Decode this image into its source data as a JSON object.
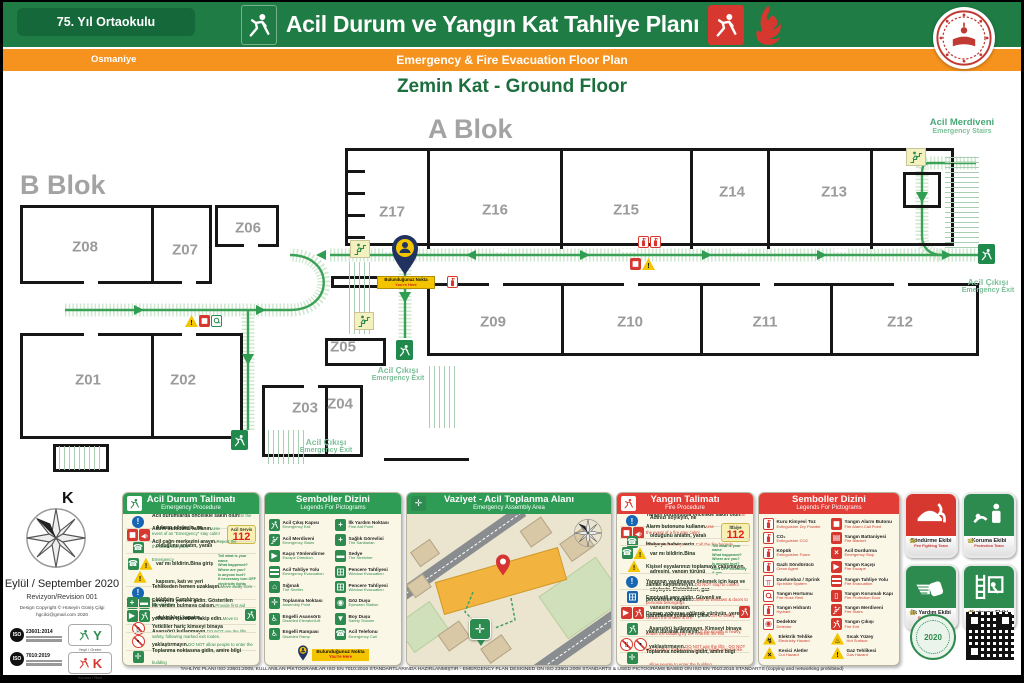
{
  "header": {
    "school_name": "75. Yıl Ortaokulu",
    "city": "Osmaniye",
    "title_tr": "Acil Durum ve Yangın Kat Tahliye Planı",
    "title_en": "Emergency & Fire Evacuation Floor Plan",
    "floor_label": "Zemin Kat - Ground Floor"
  },
  "floor_plan": {
    "blocks": [
      "A Blok",
      "B Blok"
    ],
    "rooms": [
      {
        "id": "Z01",
        "x": 84,
        "y": 280
      },
      {
        "id": "Z02",
        "x": 179,
        "y": 280
      },
      {
        "id": "Z03",
        "x": 301,
        "y": 308
      },
      {
        "id": "Z04",
        "x": 336,
        "y": 304
      },
      {
        "id": "Z05",
        "x": 339,
        "y": 247
      },
      {
        "id": "Z06",
        "x": 244,
        "y": 128
      },
      {
        "id": "Z07",
        "x": 181,
        "y": 150
      },
      {
        "id": "Z08",
        "x": 81,
        "y": 147
      },
      {
        "id": "Z09",
        "x": 489,
        "y": 222
      },
      {
        "id": "Z10",
        "x": 626,
        "y": 222
      },
      {
        "id": "Z11",
        "x": 761,
        "y": 222
      },
      {
        "id": "Z12",
        "x": 896,
        "y": 222
      },
      {
        "id": "Z13",
        "x": 830,
        "y": 92
      },
      {
        "id": "Z14",
        "x": 728,
        "y": 92
      },
      {
        "id": "Z15",
        "x": 622,
        "y": 110
      },
      {
        "id": "Z16",
        "x": 491,
        "y": 110
      },
      {
        "id": "Z17",
        "x": 388,
        "y": 112
      }
    ],
    "labels": {
      "emergency_exit_tr": "Acil Çıkışı",
      "emergency_exit_en": "Emergency Exit",
      "emergency_stairs_tr": "Acil Merdiveni",
      "emergency_stairs_en": "Emergency Stairs",
      "you_are_here_tr": "Bulunduğunuz Nokta",
      "you_are_here_en": "You're Here"
    }
  },
  "panels": {
    "emergency": {
      "title": "Acil Durum Talimatı",
      "subtitle": "Emergency Procedure",
      "rows": [
        {
          "icons": [
            "info-circle"
          ],
          "tr": "Acil durumlarda öncelikle sakin olun!",
          "en": "In the event of an \"Emergency\" stay calm!"
        },
        {
          "icons": [
            "alarm-button",
            "megaphone"
          ],
          "tr": "Alarm butonunu kullanın.",
          "en": "Use the alarm call point",
          "badge": {
            "title": "Acil Servis",
            "number": "112"
          }
        },
        {
          "icons": [
            "emergency-phone"
          ],
          "tr": "Acil çağrı merkezini arayın.",
          "en": "Report the Emergency"
        },
        {
          "icons": [
            "emergency-phone",
            "warning",
            "warning"
          ],
          "tr": "Adınızı söyleyin, ne olduğunu anlatın, yaralı var mı bildirin.",
          "tr2": "Bina giriş kapısını, katı ve yeri bildirin. Gerekirse elektrikleri kapatın.",
          "side": [
            "Tell what is your name",
            "What happened?",
            "Where are you?",
            "Is anyone hurt?",
            "If necessary turn OFF electricity lights"
          ]
        },
        {
          "icons": [
            "info-circle"
          ],
          "tr": "Tehlikeden hemen uzaklaşın.",
          "en": "Move away from any danger"
        },
        {
          "icons": [
            "first-aid",
            "stretcher"
          ],
          "tr": "İlk yardım bulmaya çalışın.",
          "en": "Provide first aid"
        },
        {
          "icons": [
            "arrow-green",
            "evacuation"
          ],
          "tr": "Emniyetli yerlere gidin. Gösterilen yollardan işaretleri takip edin.",
          "en": "Move to safety, following marked exit routes.",
          "trail": "exit-mini"
        },
        {
          "icons": [
            "no-elevator"
          ],
          "tr": "Asansörü kullanmayın.",
          "en": "DO NOT use the lifts"
        },
        {
          "icons": [
            "no-entry"
          ],
          "tr": "Yetkililer hariç kimseyi binaya yaklaştırmayın.",
          "en": "DO NOT allow people to enter the building"
        },
        {
          "icons": [
            "assembly-point"
          ],
          "tr": "Toplanma noktasına gidin, amire bilgi verin.",
          "en": "Proceed directly to your assembly point"
        }
      ]
    },
    "legend_green": {
      "title": "Semboller Dizini",
      "subtitle": "Legends For Pictograms",
      "items": [
        {
          "icon": "exit-door",
          "tr": "Acil Çıkış Kapısı",
          "en": "Emergency Exit"
        },
        {
          "icon": "emergency-stairs",
          "tr": "Acil Merdiveni",
          "en": "Emergency Stairs"
        },
        {
          "icon": "escape-direction",
          "tr": "Kaçış Yönlendirme",
          "en": "Escape Direction"
        },
        {
          "icon": "evacuation-route",
          "tr": "Acil Tahliye Yolu",
          "en": "Emergency Evacuation"
        },
        {
          "icon": "shelter",
          "tr": "Sığınak",
          "en": "The Shelter"
        },
        {
          "icon": "assembly-point",
          "tr": "Toplanma Noktası",
          "en": "Assembly Point"
        },
        {
          "icon": "disabled-lift",
          "tr": "Engelli Asansörü",
          "en": "Disabled Elevator/Lift"
        },
        {
          "icon": "disabled-ramp",
          "tr": "Engelli Rampası",
          "en": "Disabled Ramp"
        },
        {
          "icon": "first-aid",
          "tr": "İlk Yardım Noktası",
          "en": "First Aid Point"
        },
        {
          "icon": "sanitarian",
          "tr": "Sağlık Görevlisi",
          "en": "The Sanitarian"
        },
        {
          "icon": "stretcher",
          "tr": "Sedye",
          "en": "The Stretcher"
        },
        {
          "icon": "window-evac",
          "tr": "Pencere Tahliyesi",
          "en": "Window Evacuation"
        },
        {
          "icon": "window-evac",
          "tr": "Pencere Tahliyesi",
          "en": "Window Evacuation"
        },
        {
          "icon": "eyewash",
          "tr": "Göz Duşu",
          "en": "Eyewash Station"
        },
        {
          "icon": "safety-shower",
          "tr": "Boy Duşu",
          "en": "Safety Shower"
        },
        {
          "icon": "emergency-phone-green",
          "tr": "Acil Telefonu",
          "en": "Emergency Call"
        }
      ]
    },
    "assembly_map": {
      "title": "Vaziyet - Acil Toplanma Alanı",
      "subtitle": "Emergency Assembly Area"
    },
    "fire": {
      "title": "Yangın Talimatı",
      "subtitle": "Fire Procedure",
      "rows": [
        {
          "icons": [
            "info-circle"
          ],
          "tr": "Yangın durumunda öncelikle sakin olun!",
          "en": "In the event of a fire stay calm!"
        },
        {
          "icons": [
            "alarm-button",
            "megaphone"
          ],
          "tr": "Alarm butonunu kullanın.",
          "en": "Use the fire alarm call point",
          "badge": {
            "title": "İtfaiye",
            "number": "112"
          }
        },
        {
          "icons": [
            "emergency-phone"
          ],
          "tr": "İtfaiyeye haber verin.",
          "en": "Call the fire brigade"
        },
        {
          "icons": [
            "emergency-phone",
            "warning",
            "warning"
          ],
          "tr": "Adınızı söyleyin, ne olduğunu anlatın, yaralı var mı bildirin.",
          "tr2": "Bina adresini, yangın türünü söyleyin. Elektrikleri, gaz vanasını kapatın.",
          "side": [
            "Tell what is your name",
            "What happened?",
            "Where are you?",
            "Is anyone hurt?",
            "Turn OFF electricity & gas"
          ]
        },
        {
          "icons": [
            "info-circle"
          ],
          "tr": "Kişisel eşyalarınızı toplamaya çalışmayın, zaman kaybetmeyin.",
          "en": "DO NOT stop to collect personal belongings"
        },
        {
          "icons": [
            "window-close"
          ],
          "tr": "Yangının yayılmasını önlemek için kapı ve pencereleri kapatın.",
          "en": "Close all windows & doors to contain the smoke & fire."
        },
        {
          "icons": [
            "arrow-red",
            "fire-exit-mini"
          ],
          "tr": "Emniyetli yere gidin. Güvenli ve işaretlenen yollardan çıkın.",
          "en": "Get to safety. Leave the building by the nearest fire exit",
          "trail": "fire-exit-mini"
        },
        {
          "icons": [
            "crawl"
          ],
          "tr": "Duman yoğunsa eğilerek yürüyün, yere yakın durarak ilerleyin.",
          "en": "If the smoke is heavy, stay close to the ground, you'll breathe less smoke."
        },
        {
          "icons": [
            "no-elevator",
            "no-entry"
          ],
          "tr": "Asansörü kullanmayın. Kimseyi binaya yaklaştırmayın.",
          "en": "DO NOT use the lifts · DO NOT allow people to enter the building"
        },
        {
          "icons": [
            "assembly-point"
          ],
          "tr": "Toplanma noktasına gidin, amire bilgi verin.",
          "en": "Proceed directly to your assembly point"
        }
      ]
    },
    "legend_red": {
      "title": "Semboller Dizini",
      "subtitle": "Legends For Pictograms",
      "items": [
        {
          "icon": "ext-powder",
          "tr": "Kuru Kimyevi Toz",
          "en": "Extinguisher Dry Powder"
        },
        {
          "icon": "ext-co2",
          "tr": "CO₂",
          "en": "Extinguisher CO2"
        },
        {
          "icon": "ext-foam",
          "tr": "Köpük",
          "en": "Extinguisher Foam"
        },
        {
          "icon": "ext-clean",
          "tr": "Gazlı Söndürücü",
          "en": "Clean Agent"
        },
        {
          "icon": "sprinkler",
          "tr": "Davlumbaz / Sprink",
          "en": "Sprinkler System"
        },
        {
          "icon": "fire-hose",
          "tr": "Yangın Hortumu",
          "en": "Fire Hose Reel"
        },
        {
          "icon": "hydrant",
          "tr": "Yangın Hidrantı",
          "en": "Hydrant"
        },
        {
          "icon": "detector",
          "tr": "Dedektör",
          "en": "Detector"
        },
        {
          "icon": "electric-hazard",
          "tr": "Elektrik Tehlike",
          "en": "Electricity Hazard"
        },
        {
          "icon": "cut-hazard",
          "tr": "Kesici Aletler",
          "en": "Cut Hazard"
        },
        {
          "icon": "fire-alarm",
          "tr": "Yangın Alarm Butonu",
          "en": "Fire Alarm Call Point"
        },
        {
          "icon": "fire-blanket",
          "tr": "Yangın Battaniyesi",
          "en": "Fire Blanket"
        },
        {
          "icon": "emergency-stop",
          "tr": "Acil Durdurma",
          "en": "Emergency Stop"
        },
        {
          "icon": "fire-escape",
          "tr": "Yangın Kaçışı",
          "en": "Fire Escape"
        },
        {
          "icon": "fire-route",
          "tr": "Yangın Tahliye Yolu",
          "en": "Fire Evacuation"
        },
        {
          "icon": "fire-door",
          "tr": "Yangın Korumalı Kapı",
          "en": "Fire Protection Door"
        },
        {
          "icon": "fire-stairs",
          "tr": "Yangın Merdiveni",
          "en": "Fire Stairs"
        },
        {
          "icon": "fire-exit",
          "tr": "Yangın Çıkışı",
          "en": "Fire Exit"
        },
        {
          "icon": "hot-surface",
          "tr": "Sıcak Yüzey",
          "en": "Hot Surface"
        },
        {
          "icon": "gas-hazard",
          "tr": "Gaz Tehlikesi",
          "en": "Gas Hazard"
        }
      ]
    }
  },
  "teams": [
    {
      "tr": "Söndürme Ekibi",
      "en": "Fire Fighting Team",
      "color": "#d6382f",
      "icon": "helmet-flame"
    },
    {
      "tr": "Koruma Ekibi",
      "en": "Protection Team",
      "color": "#2e8b4f",
      "icon": "protection"
    },
    {
      "tr": "İlk Yardım Ekibi",
      "en": "First Aid Team",
      "color": "#2e8b4f",
      "icon": "first-aid-hand"
    },
    {
      "tr": "Kurtarma Ekibi",
      "en": "Rescue Team",
      "color": "#2e8b4f",
      "icon": "ladder-rescue"
    }
  ],
  "info": {
    "north": "K",
    "date": "Eylül / September 2020",
    "revision": "Revizyon/Revision  001",
    "copyright_line1": "Design Copyright © Hüseyin Güniş Çilgi",
    "copyright_line2": "hgcilci@gmail.com 2020",
    "iso_1": "23601:2014",
    "iso_2": "7010:2019",
    "green_key_letter": "Y",
    "green_key_label": "Yeşil / Green",
    "red_key_letter": "K",
    "red_key_label": "Kırmızı / Red",
    "seal_year": "2020"
  },
  "footer": "TAHLİYE PLANI ISO 23601:2009, KULLANILAN PİKTOGRAMLAR ISO EN 7010:2016 STANDARTLARINDA HAZIRLANMIŞTIR - EMERGENCY PLAN DESIGNED ON ISO 23601:2009 STANDARTS & USED PICTOGRAMS BASED ON ISO EN 7010:2016 STANDARTS (copying and networking prohibited)",
  "colors": {
    "green": "#1e7c44",
    "orange": "#f6921e",
    "red": "#d6382f",
    "route_green": "#2f9e52",
    "cream": "#faf7e6"
  }
}
